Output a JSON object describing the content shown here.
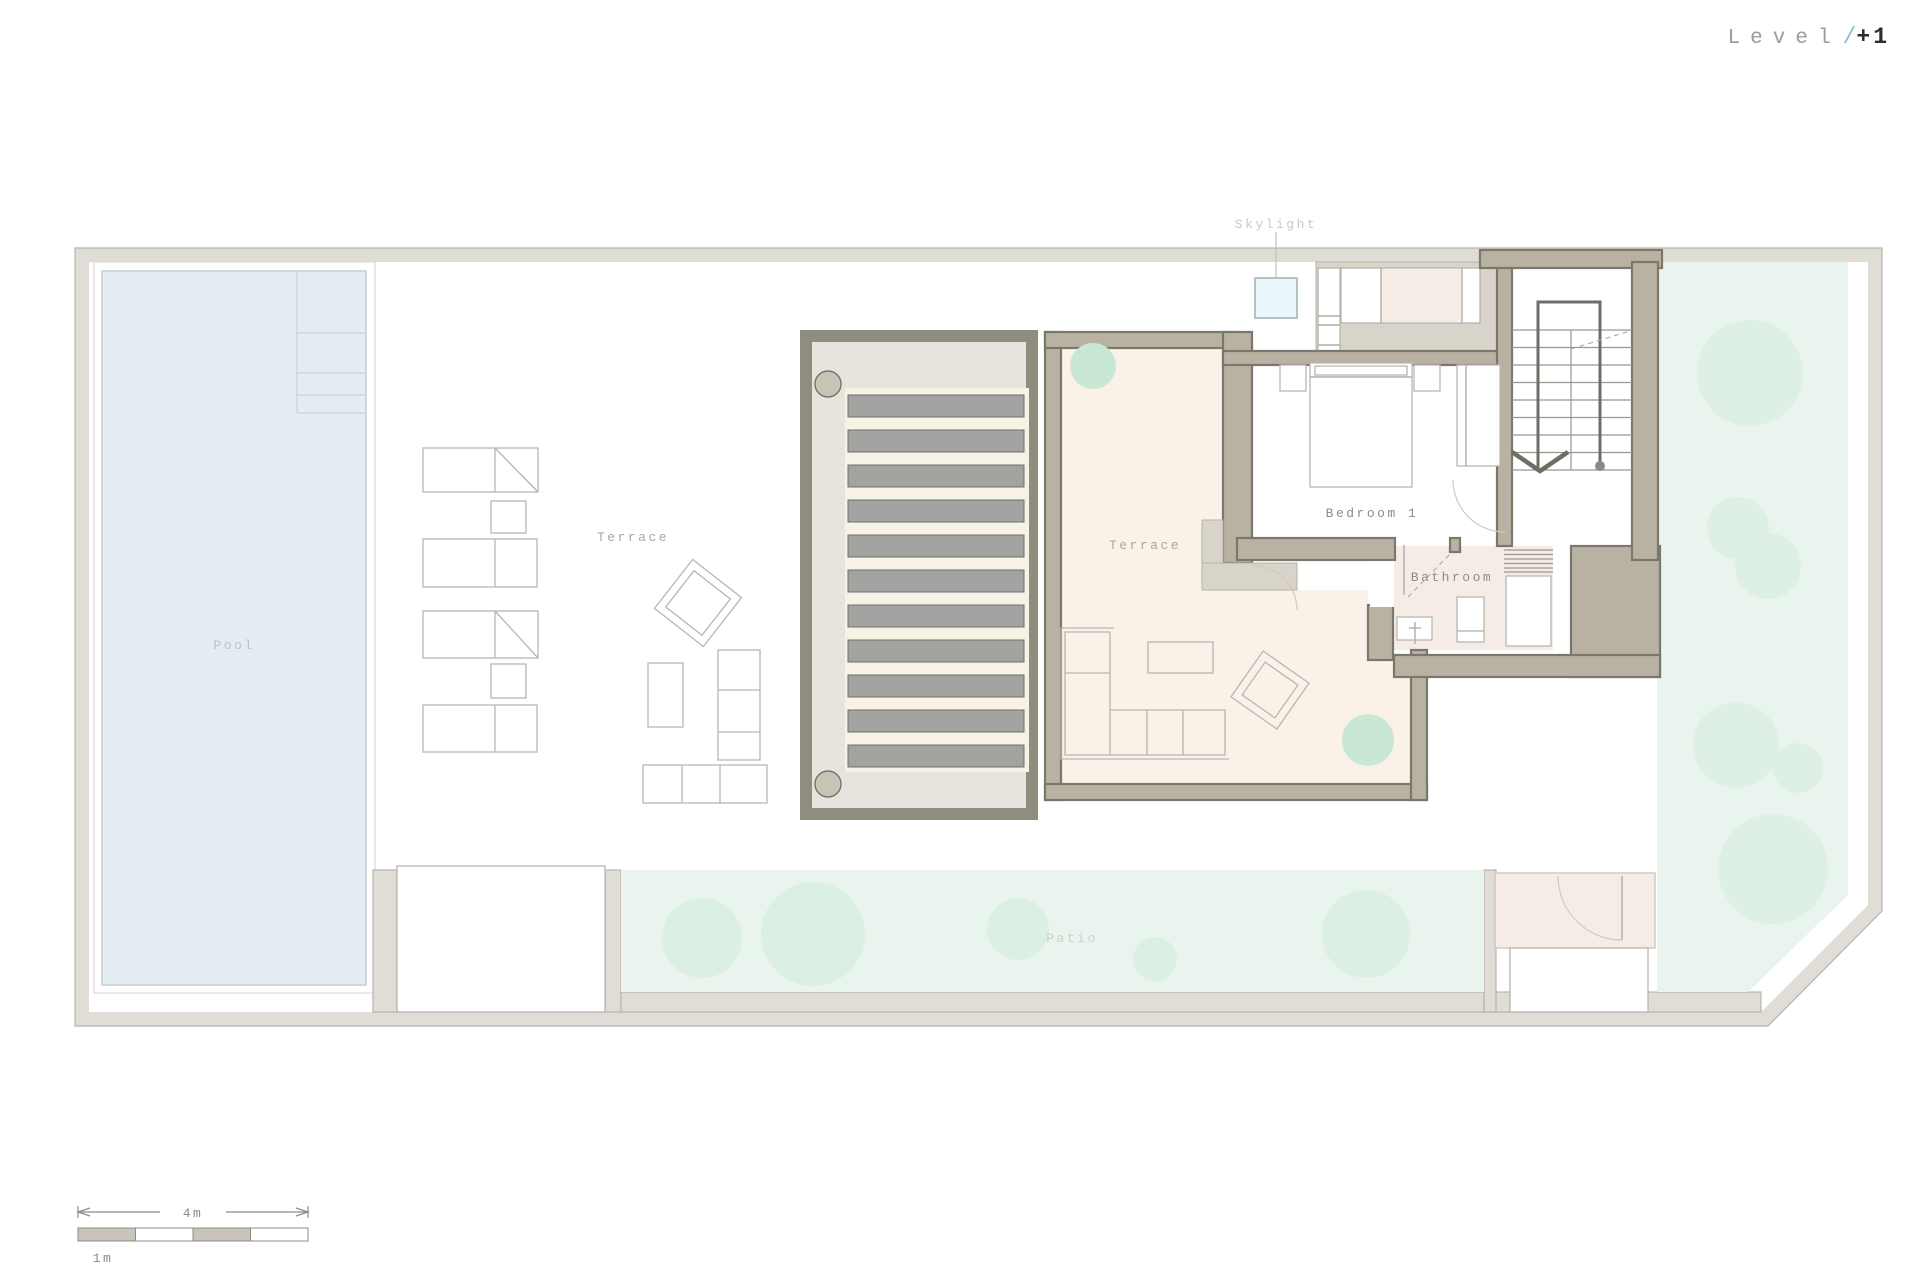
{
  "title": {
    "level": "Level",
    "slash": "/",
    "number": "+1"
  },
  "rooms": {
    "skylight": "Skylight",
    "pool": "Pool",
    "terrace_left": "Terrace",
    "terrace_main": "Terrace",
    "bedroom": "Bedroom 1",
    "bathroom": "Bathroom",
    "patio": "Patio"
  },
  "scale_bar": {
    "overall": "4m",
    "unit": "1m"
  },
  "colors": {
    "site_wall": "#e0ddd6",
    "site_stroke": "#b7b3ac",
    "wall": "#b9b2a3",
    "wall_stroke": "#7a776c",
    "wall_light": "#d8d4c9",
    "pergola_frame": "#8f8c80",
    "pergola_fill": "#e6e4dd",
    "deck": "#f6f2e6",
    "slat": "#a3a3a1",
    "slat_stroke": "#6f6f6a",
    "pool": "#e3edf2",
    "pool_stroke": "#c3ced4",
    "pool_outline": "#d9dcdc",
    "cream": "#faf1e9",
    "pink": "#f5ece5",
    "garden": "#e9f4ee",
    "tree": "#def0e5",
    "patio_circle": "#dcefe3",
    "plant": "#c9e8d4",
    "column": "#c7c3b5",
    "furn": "#b9b6b0",
    "furn_dark": "#6f6d65",
    "tread": "#9a978f",
    "sky_fill": "#e9f6fa",
    "sky_stroke": "#a3b4bb",
    "text_gray": "#9b9b98",
    "text_faint": "#c8c8c5",
    "text_pool": "#b7c4cd",
    "text_patio": "#c4d4c9",
    "text_terrace": "#aca79f",
    "text_dark": "#8f8b85",
    "title_num": "#2e2e2e",
    "title_slash": "#8fbccd"
  }
}
